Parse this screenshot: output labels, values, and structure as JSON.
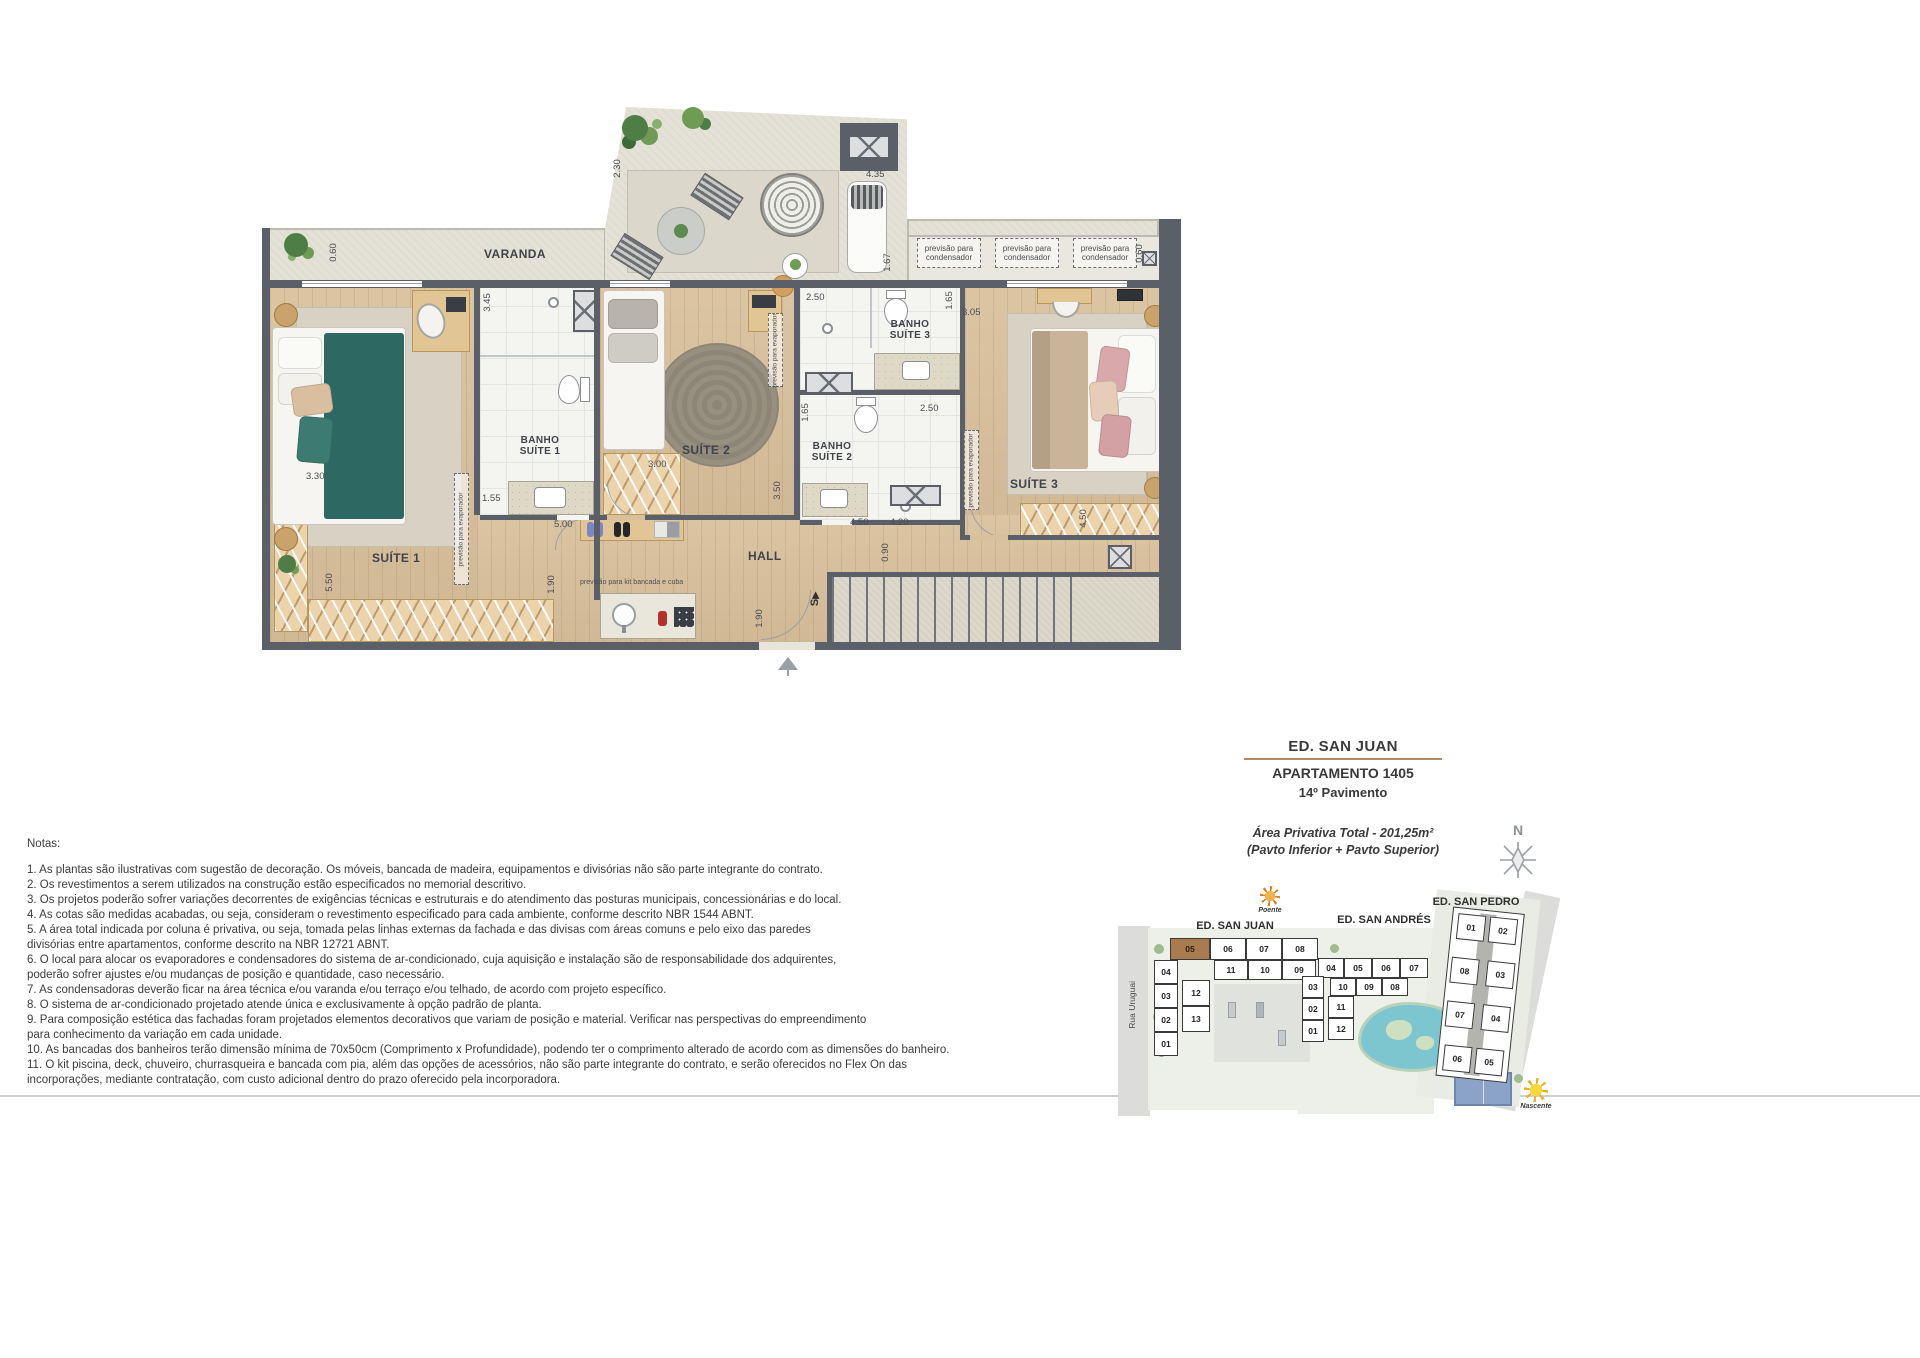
{
  "title_block": {
    "building": "ED. SAN JUAN",
    "apartment": "APARTAMENTO 1405",
    "floor": "14º Pavimento",
    "area": "Área Privativa Total - 201,25m²",
    "area_sub": "(Pavto Inferior + Pavto Superior)",
    "underline_color": "#b5895a"
  },
  "plan": {
    "rooms": {
      "varanda": "VARANDA",
      "suite1": "SUÍTE 1",
      "suite2": "SUÍTE 2",
      "suite3": "SUÍTE 3",
      "hall": "HALL",
      "banho1_l1": "BANHO",
      "banho1_l2": "SUÍTE 1",
      "banho2_l1": "BANHO",
      "banho2_l2": "SUÍTE 2",
      "banho3_l1": "BANHO",
      "banho3_l2": "SUÍTE 3"
    },
    "annotations": {
      "cond_l1": "previsão para",
      "cond_l2": "condensador",
      "evaporador": "previsão para evaporador",
      "kit_bancada": "previsão para kit bancada e cuba",
      "stairs": "S"
    },
    "dims": {
      "v230": "2.30",
      "h435": "4.35",
      "v167": "1.67",
      "v060l": "0.60",
      "v060r": "0.60",
      "h250b3": "2.50",
      "v165b3": "1.65",
      "h305": "3.05",
      "v345": "3.45",
      "v165b2": "1.65",
      "h250b2": "2.50",
      "h330": "3.30",
      "h155": "1.55",
      "h300": "3.00",
      "v350": "3.50",
      "h500": "5.00",
      "v550": "5.50",
      "v190a": "1.90",
      "v190b": "1.90",
      "h450a": "4.50",
      "h420": "4.20",
      "v090": "0.90",
      "v450b": "4.50"
    },
    "wall_color": "#5b6068"
  },
  "compass": {
    "label": "N"
  },
  "notes": {
    "title": "Notas:",
    "lines": [
      "1. As plantas são ilustrativas com sugestão de decoração. Os móveis, bancada de madeira, equipamentos e divisórias não são parte integrante do contrato.",
      "2. Os revestimentos a serem utilizados na construção estão especificados no memorial descritivo.",
      "3. Os projetos poderão sofrer variações decorrentes de exigências técnicas e estruturais e do atendimento das posturas municipais, concessionárias e do local.",
      "4. As cotas são medidas acabadas, ou seja, consideram o revestimento especificado para cada ambiente, conforme descrito NBR 1544 ABNT.",
      "5. A área total indicada por coluna é privativa, ou seja, tomada pelas linhas externas da fachada e das divisas com áreas comuns e pelo eixo das paredes",
      "divisórias entre apartamentos, conforme descrito na NBR 12721 ABNT.",
      "6. O local para alocar os evaporadores e condensadores do sistema de ar-condicionado, cuja aquisição e instalação são de responsabilidade dos adquirentes,",
      "poderão sofrer ajustes e/ou mudanças de posição e quantidade, caso necessário.",
      "7. As condensadoras deverão ficar na área técnica e/ou varanda e/ou terraço e/ou telhado, de acordo com projeto específico.",
      "8. O sistema de ar-condicionado projetado atende única e exclusivamente à opção padrão de planta.",
      "9. Para composição estética das fachadas foram projetados elementos decorativos que variam de posição e material. Verificar nas perspectivas do empreendimento",
      "para conhecimento da variação em cada unidade.",
      "10. As bancadas dos banheiros terão dimensão mínima de 70x50cm (Comprimento x Profundidade), podendo ter o comprimento alterado de acordo com as dimensões do banheiro.",
      "11. O kit piscina, deck, chuveiro, churrasqueira e bancada com pia, além das opções de acessórios, não são parte integrante do contrato, e serão oferecidos no Flex On das",
      "incorporações, mediante contratação, com custo adicional dentro do prazo oferecido pela incorporadora."
    ]
  },
  "siteplan": {
    "poente": "Poente",
    "nascente": "Nascente",
    "rua_uruguai": "Rua Uruguai",
    "rua_delfina": "Rua Dona Delfina",
    "highlight_color": "#a97c50",
    "sj": {
      "name": "ED. SAN JUAN",
      "units": [
        "05",
        "06",
        "07",
        "08",
        "11",
        "10",
        "09",
        "04",
        "03",
        "02",
        "01",
        "12",
        "13"
      ]
    },
    "sa": {
      "name": "ED. SAN ANDRÉS",
      "units": [
        "04",
        "05",
        "06",
        "07",
        "10",
        "09",
        "08",
        "03",
        "02",
        "01",
        "11",
        "12"
      ]
    },
    "sp": {
      "name": "ED. SAN PEDRO",
      "units": [
        "01",
        "02",
        "08",
        "03",
        "07",
        "04",
        "06",
        "05"
      ]
    }
  }
}
